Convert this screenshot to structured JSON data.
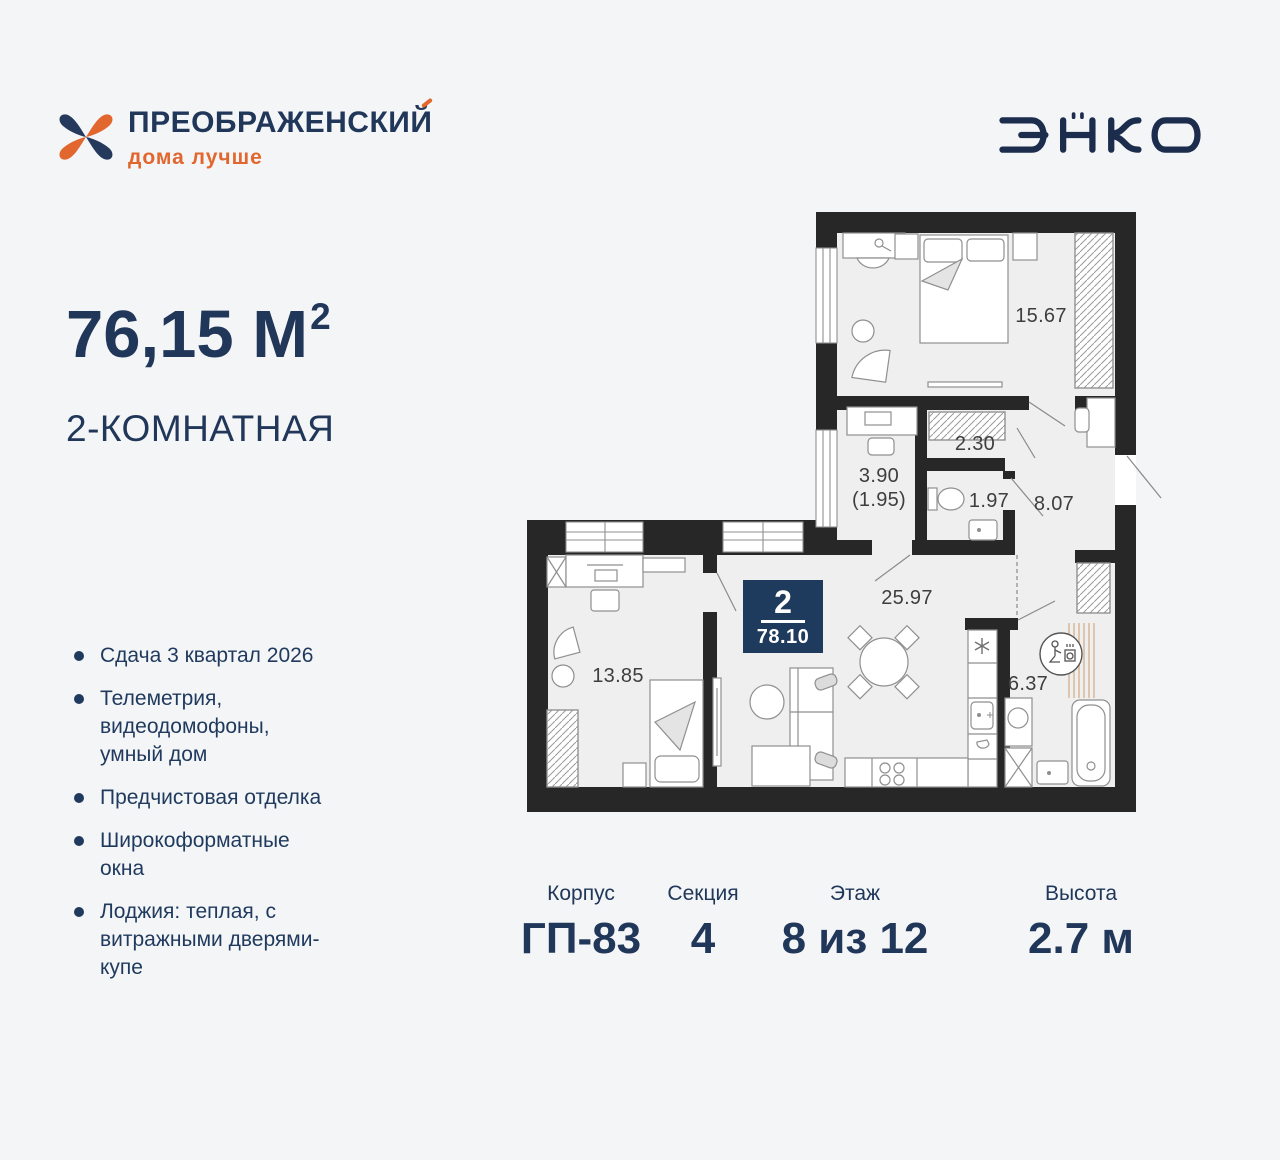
{
  "brand": {
    "name": "ПРЕОБРАЖЕНСКИЙ",
    "tagline": "дома лучше",
    "developer": "ЭНКО"
  },
  "colors": {
    "navy": "#20375a",
    "orange": "#e2672e",
    "wall": "#272727",
    "badge_bg": "#1e3a5c",
    "room_fill": "#efefef"
  },
  "offer": {
    "area_value": "76,15 М",
    "area_sup": "2",
    "rooms_title": "2-КОМНАТНАЯ"
  },
  "features": [
    "Сдача 3 квартал 2026",
    "Телеметрия, видеодомофоны, умный дом",
    "Предчистовая отделка",
    "Широкоформатные окна",
    "Лоджия: теплая, с витражными дверями-купе"
  ],
  "plan": {
    "badge": {
      "rooms": "2",
      "total_area": "78.10"
    },
    "rooms": [
      {
        "id": "bedroom",
        "area": "15.67"
      },
      {
        "id": "wardrobe",
        "area": "2.30"
      },
      {
        "id": "loggia",
        "area": "3.90",
        "area_reduced": "(1.95)"
      },
      {
        "id": "wc",
        "area": "1.97"
      },
      {
        "id": "hallway",
        "area": "8.07"
      },
      {
        "id": "kitchen-living",
        "area": "25.97"
      },
      {
        "id": "bedroom-second",
        "area": "13.85"
      },
      {
        "id": "bathroom",
        "area": "6.37"
      }
    ]
  },
  "specs": [
    {
      "label": "Корпус",
      "value": "ГП-83"
    },
    {
      "label": "Секция",
      "value": "4"
    },
    {
      "label": "Этаж",
      "value": "8 из 12"
    },
    {
      "label": "Высота",
      "value": "2.7 м"
    }
  ]
}
